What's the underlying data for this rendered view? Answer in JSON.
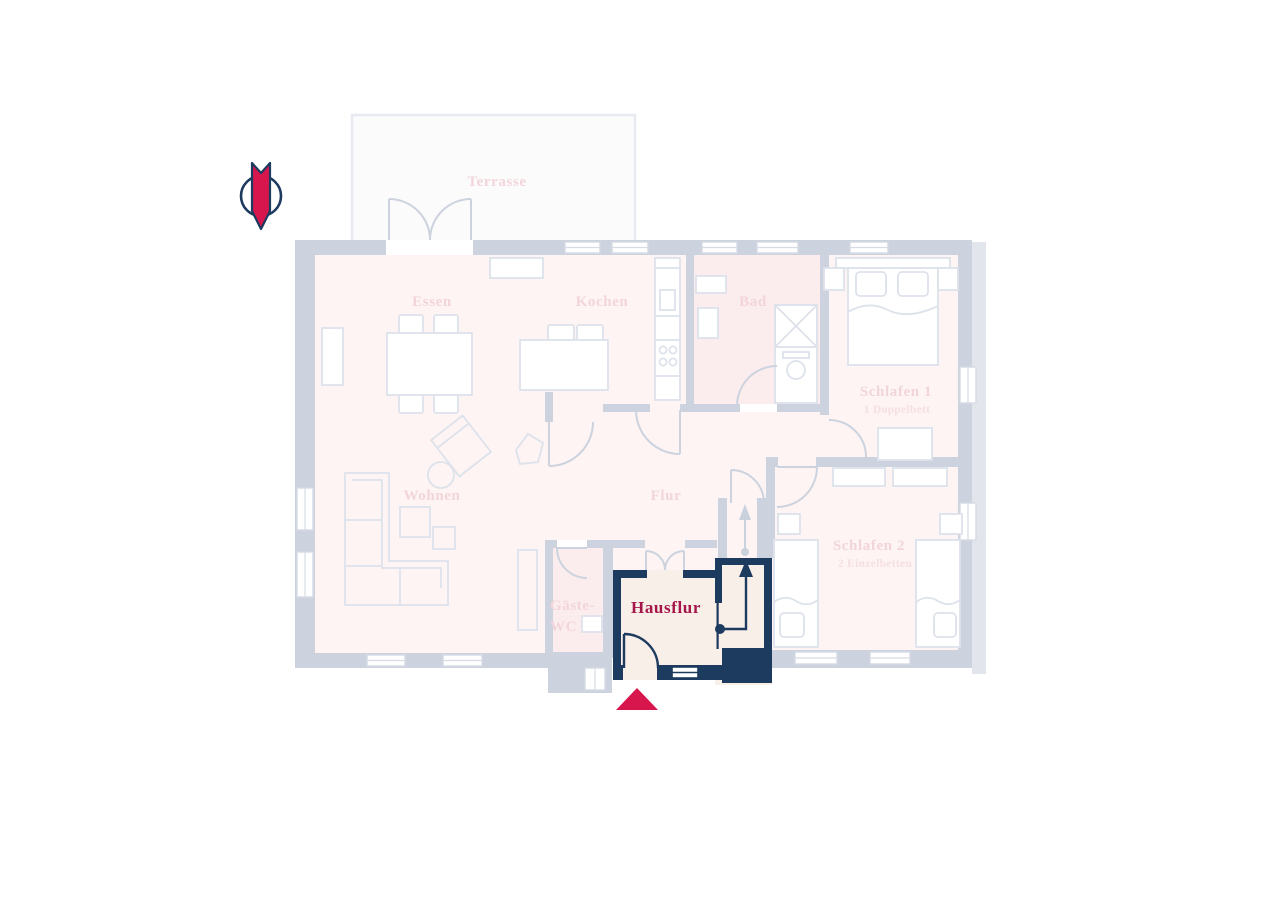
{
  "floorplan": {
    "rooms": {
      "terrasse": "Terrasse",
      "essen": "Essen",
      "kochen": "Kochen",
      "bad": "Bad",
      "schlafen1": "Schlafen 1",
      "schlafen1_sub": "1 Doppelbett",
      "wohnen": "Wohnen",
      "flur": "Flur",
      "gaeste_wc_line1": "Gäste-",
      "gaeste_wc_line2": "WC",
      "schlafen2": "Schlafen 2",
      "schlafen2_sub": "2 Einzelbetten",
      "hausflur": "Hausflur"
    },
    "colors": {
      "highlight_navy": "#1d3a5f",
      "accent_crimson": "#d8164e",
      "label_crimson": "#a5174a",
      "wall_gray": "#ccd3de",
      "faded_label_pink": "#f2d5da",
      "hausflur_fill": "#f9efe9"
    },
    "icons": {
      "north_arrow": "north-arrow-icon",
      "entrance_marker": "entrance-triangle-icon"
    }
  }
}
